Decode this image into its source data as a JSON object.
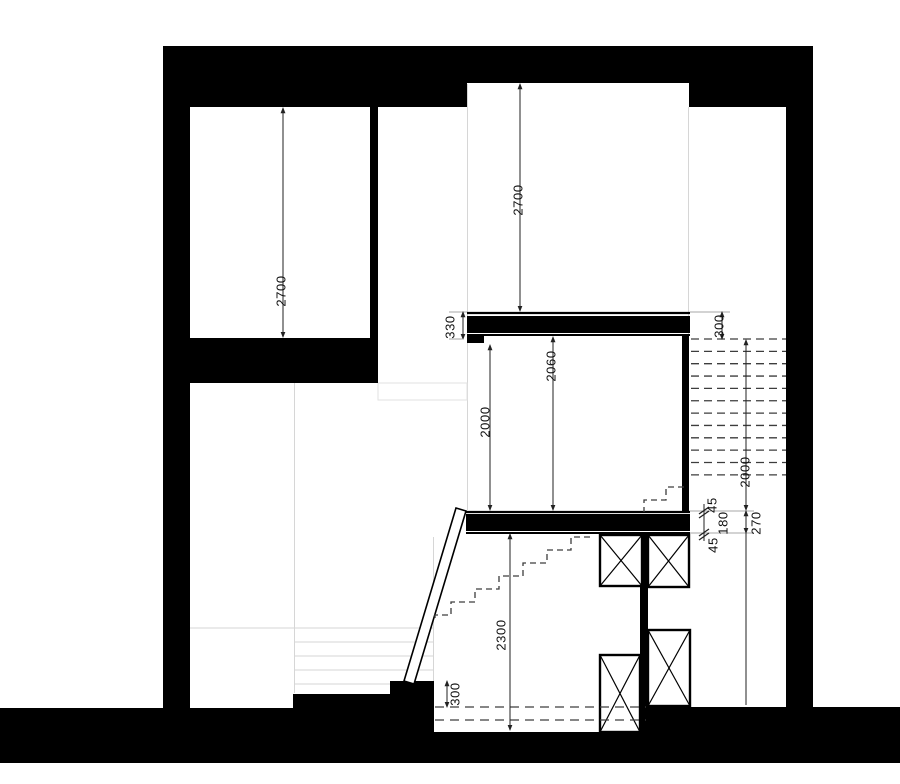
{
  "app": {
    "title": "Stair section drawing"
  },
  "drawing": {
    "units": "mm",
    "colors": {
      "ink": "#000000",
      "dimension": "#222222",
      "hidden_line": "#444444",
      "faint": "#cfcfcf",
      "background": "#ffffff"
    },
    "dims": {
      "left_room_height": "2700",
      "hall_height": "2700",
      "upper_beam_edge": "330",
      "landing_first_riser": "300",
      "balustrade_opening": "2060",
      "clear_opening": "2000",
      "upper_flight_run": "2000",
      "trim_top": "45",
      "beam_core": "180",
      "trim_bottom": "45",
      "beam_total": "270",
      "lower_room_height": "2300",
      "floor_step": "300"
    },
    "hidden_treads": {
      "count": 12,
      "x1": 691,
      "x2": 786,
      "y_start": 339,
      "spacing": 12.35
    }
  }
}
